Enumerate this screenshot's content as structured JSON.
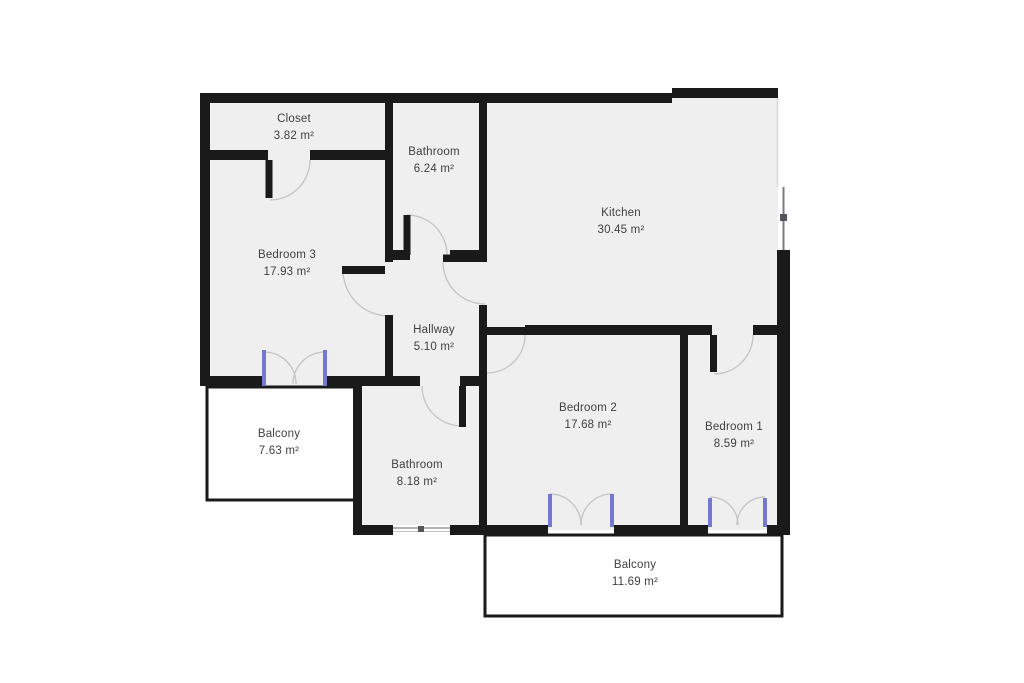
{
  "floor_plan": {
    "rooms": [
      {
        "name": "Closet",
        "area": "3.82 m²"
      },
      {
        "name": "Bathroom",
        "area": "6.24 m²"
      },
      {
        "name": "Kitchen",
        "area": "30.45 m²"
      },
      {
        "name": "Bedroom 3",
        "area": "17.93 m²"
      },
      {
        "name": "Hallway",
        "area": "5.10 m²"
      },
      {
        "name": "Bedroom 2",
        "area": "17.68 m²"
      },
      {
        "name": "Bedroom 1",
        "area": "8.59 m²"
      },
      {
        "name": "Balcony",
        "area": "7.63 m²"
      },
      {
        "name": "Bathroom",
        "area": "8.18 m²"
      },
      {
        "name": "Balcony",
        "area": "11.69 m²"
      }
    ],
    "colors": {
      "wall": "#1a1a1a",
      "room_fill": "#efeff0",
      "balcony_fill": "#ffffff",
      "door_arc": "#c4c4c4",
      "french_door_frame": "#7678cf",
      "label_text": "#404040",
      "window_line": "#9a9a9a",
      "background": "#ffffff"
    }
  }
}
